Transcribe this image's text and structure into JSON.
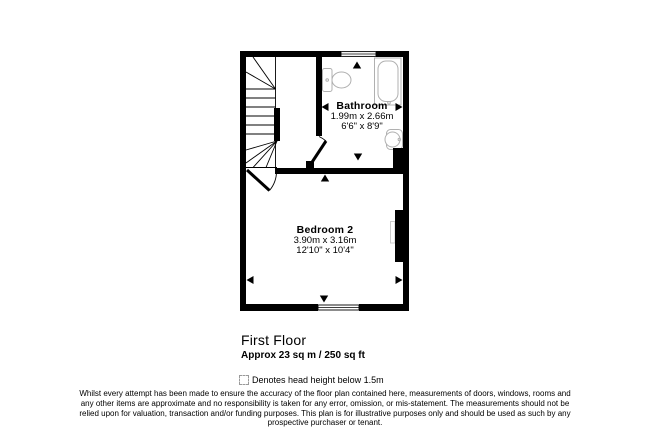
{
  "plan": {
    "rooms": [
      {
        "name": "Bathroom",
        "dim_metric": "1.99m x 2.66m",
        "dim_imperial": "6'6\" x 8'9\""
      },
      {
        "name": "Bedroom 2",
        "dim_metric": "3.90m x 3.16m",
        "dim_imperial": "12'10\" x 10'4\""
      }
    ],
    "icons": [
      "staircase",
      "toilet-icon",
      "bathtub-icon",
      "sink-icon",
      "radiator",
      "window",
      "door-arc",
      "dimension-arrow"
    ]
  },
  "footer": {
    "floor_title": "First Floor",
    "floor_area": "Approx 23 sq m / 250 sq ft",
    "legend_note": "Denotes head height below 1.5m",
    "disclaimer_lines": [
      "Whilst every attempt has been made to ensure the accuracy of the floor plan contained here, measurements of doors, windows, rooms and",
      "any other items are approximate and no responsibility is taken for any error, omission, or mis-statement. The measurements should not be",
      "relied upon for valuation, transaction and/or funding purposes. This plan is for illustrative purposes only and should be used as such by any",
      "prospective purchaser or tenant."
    ]
  },
  "colors": {
    "wall": "#000000",
    "fixture_outline": "#b0b0b0",
    "background": "#ffffff"
  }
}
